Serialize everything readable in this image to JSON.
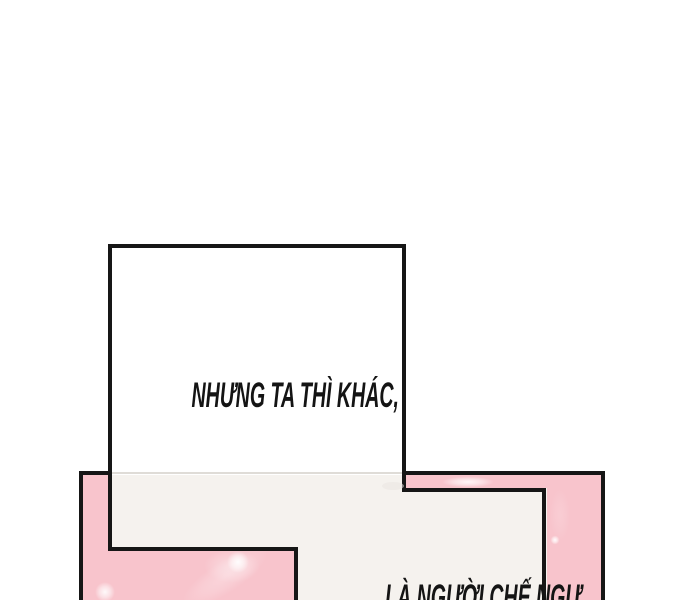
{
  "dialogue": {
    "top_bubble_text": "NHƯNG TA THÌ KHÁC,",
    "bottom_bubble_text": "LÀ NGƯỜI CHẾ NGỰ"
  },
  "colors": {
    "page_bg": "#ffffff",
    "panel_pink": "#f8c4cc",
    "sparkle_white": "#ffffff",
    "bubble_white": "#ffffff",
    "bubble_offwhite": "#f5f2ee",
    "line_black": "#161616",
    "faint_line": "#dcd8d3",
    "text_color": "#141414"
  }
}
